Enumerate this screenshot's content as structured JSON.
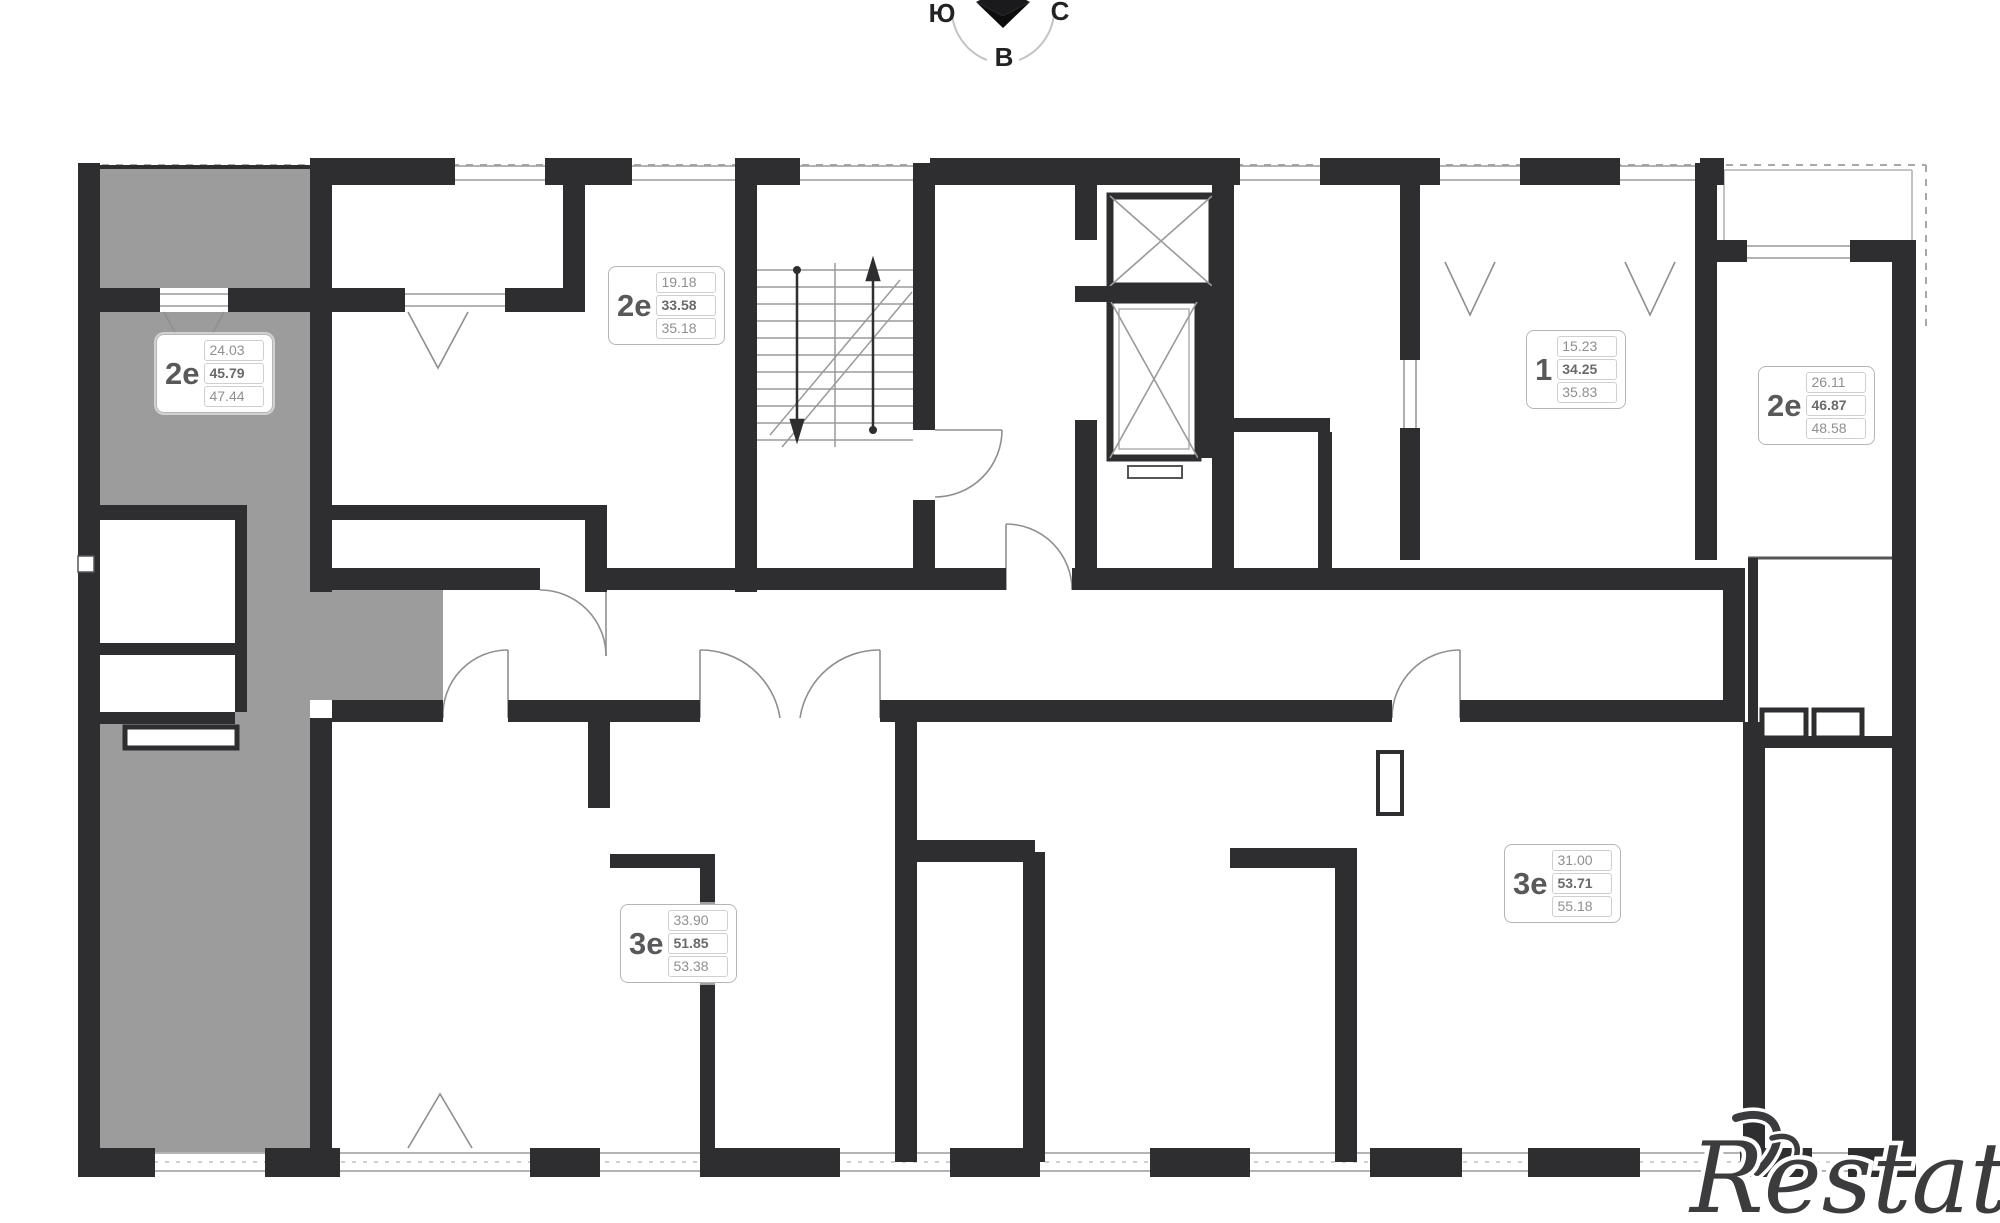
{
  "compass": {
    "south": "Ю",
    "north": "С",
    "east": "В"
  },
  "watermark": {
    "text": "Restate"
  },
  "apartments": [
    {
      "id": "apt-2e-selected",
      "type": "2е",
      "area_room": "24.03",
      "area_living": "45.79",
      "area_total": "47.44",
      "selected": true
    },
    {
      "id": "apt-2e-top",
      "type": "2е",
      "area_room": "19.18",
      "area_living": "33.58",
      "area_total": "35.18",
      "selected": false
    },
    {
      "id": "apt-1-top-right",
      "type": "1",
      "area_room": "15.23",
      "area_living": "34.25",
      "area_total": "35.83",
      "selected": false
    },
    {
      "id": "apt-2e-right",
      "type": "2е",
      "area_room": "26.11",
      "area_living": "46.87",
      "area_total": "48.58",
      "selected": false
    },
    {
      "id": "apt-3e-bottom-left",
      "type": "3е",
      "area_room": "33.90",
      "area_living": "51.85",
      "area_total": "53.38",
      "selected": false
    },
    {
      "id": "apt-3e-bottom-right",
      "type": "3е",
      "area_room": "31.00",
      "area_living": "53.71",
      "area_total": "55.18",
      "selected": false
    }
  ],
  "colors": {
    "wall": "#2e2e30",
    "highlight": "#9c9c9c",
    "thin_line": "#9a9a9a",
    "watermark": "#3c3c3e"
  }
}
